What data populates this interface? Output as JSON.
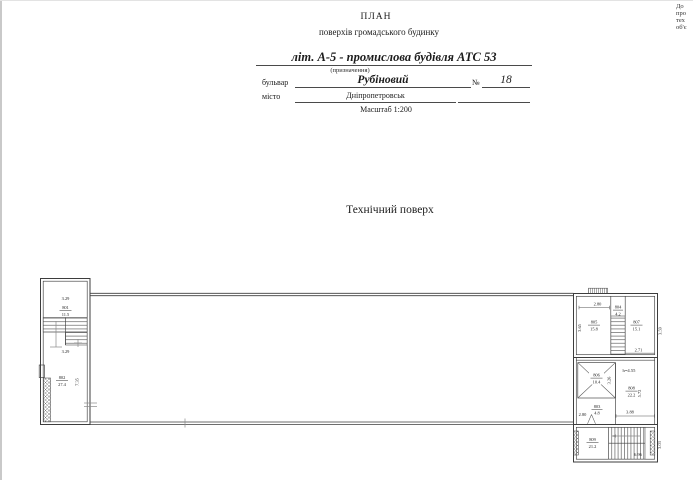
{
  "corner_note": {
    "lines": [
      "До",
      "про",
      "тех",
      "об'є"
    ]
  },
  "header": {
    "title": "ПЛАН",
    "subtitle": "поверхів громадського будинку",
    "building_line": "літ. А-5 - промислова будівля АТС 53",
    "purpose_note": "(призначення)",
    "street_label": "бульвар",
    "street_value": "Рубіновий",
    "number_sign": "№",
    "number_value": "18",
    "city_label": "місто",
    "city_value": "Дніпропетровськ",
    "scale_note": "Масштаб 1:200"
  },
  "section_title": "Технічний поверх",
  "plan": {
    "rooms": {
      "r801": {
        "num": "801",
        "area": "11.5"
      },
      "r802": {
        "num": "802",
        "area": "27.4"
      },
      "r803": {
        "num": "803",
        "area": "4.8"
      },
      "r804": {
        "num": "804",
        "area": "4.2"
      },
      "r805": {
        "num": "805",
        "area": "15.8"
      },
      "r806": {
        "num": "806",
        "area": "10.4"
      },
      "r807": {
        "num": "807",
        "area": "15.1"
      },
      "r808": {
        "num": "808",
        "area": "22.2"
      },
      "r809": {
        "num": "809",
        "area": "21.2"
      }
    },
    "dims": {
      "left_top": "3.29",
      "left_mid": "3.29",
      "left_height": "7.35",
      "right_top": "2.80",
      "d805": "3.65",
      "d807": "3.59",
      "d807w": "2.71",
      "d806": "3.26",
      "d808h": "5.72",
      "d803w": "2.80",
      "d808w": "3.88",
      "d809w": "6.96",
      "d809h": "3.03"
    },
    "height_note": "h=4.55"
  }
}
